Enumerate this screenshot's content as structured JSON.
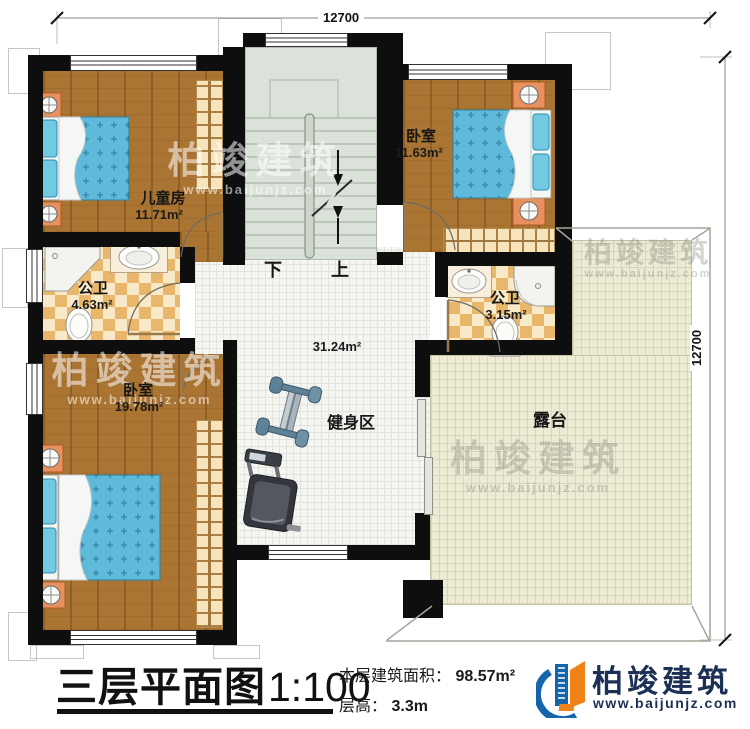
{
  "dimensions": {
    "top": "12700",
    "right": "12700"
  },
  "rooms": {
    "children": {
      "label": "儿童房",
      "area": "11.71m²"
    },
    "bedroom_tr": {
      "label": "卧室",
      "area": "11.63m²"
    },
    "bath_left": {
      "label": "公卫",
      "area": "4.63m²"
    },
    "bath_right": {
      "label": "公卫",
      "area": "3.15m²"
    },
    "bedroom_bl": {
      "label": "卧室",
      "area": "19.78m²"
    },
    "hall": {
      "area": "31.24m²"
    },
    "gym": {
      "label": "健身区"
    },
    "terrace": {
      "label": "露台"
    }
  },
  "stairs": {
    "down": "下",
    "up": "上"
  },
  "title_block": {
    "title": "三层平面图",
    "scale": "1:100",
    "area_label": "本层建筑面积：",
    "area_value": "98.57m²",
    "height_label": "层高：",
    "height_value": "3.3m"
  },
  "logo": {
    "name": "柏竣建筑",
    "website": "www.baijunjz.com"
  },
  "watermark": {
    "name": "柏竣建筑",
    "website": "www.baijunjz.com"
  },
  "colors": {
    "wall": "#0e0e0e",
    "wood": "#aa7433",
    "bed_blue": "#5fb9d9",
    "checker_tan": "#e8b76c",
    "stair_green": "#dbe2da",
    "terrace_beige": "#edebd3",
    "logo_blue": "#1565ad",
    "logo_orange": "#ef8318"
  }
}
